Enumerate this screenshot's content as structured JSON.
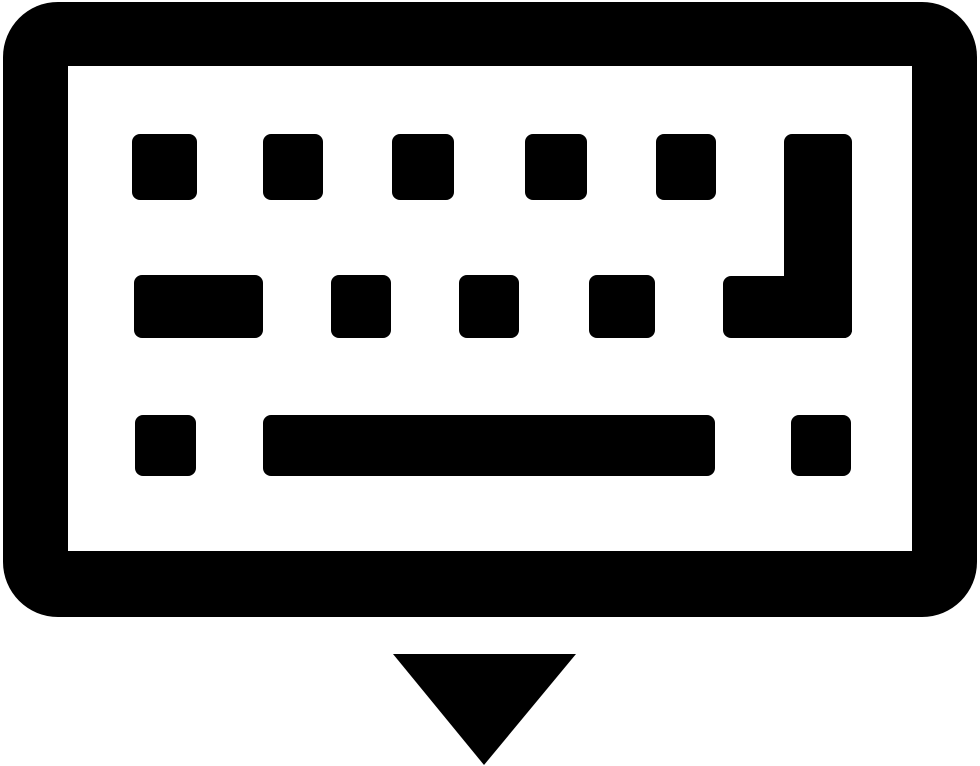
{
  "icon": {
    "name": "keyboard-hide-icon",
    "semantic": "Keyboard glyph with a downward-pointing triangle below it (hide on-screen keyboard)",
    "colors": {
      "glyph": "#000000",
      "background": "#ffffff"
    },
    "keyboard": {
      "frame": {
        "x": 3,
        "y": 2,
        "width": 974,
        "height": 615,
        "corner_radius": 55
      },
      "inner": {
        "x": 68,
        "y": 66,
        "width": 844,
        "height": 485
      },
      "key_corner_radius": 8,
      "rows": [
        {
          "name": "top-row",
          "y": 134,
          "height": 66,
          "keys": [
            {
              "name": "key",
              "x": 132,
              "w": 65
            },
            {
              "name": "key",
              "x": 263,
              "w": 60
            },
            {
              "name": "key",
              "x": 392,
              "w": 62
            },
            {
              "name": "key",
              "x": 525,
              "w": 62
            },
            {
              "name": "key",
              "x": 656,
              "w": 60
            }
          ]
        },
        {
          "name": "middle-row",
          "y": 275,
          "height": 63,
          "keys": [
            {
              "name": "wide-key",
              "x": 134,
              "w": 129
            },
            {
              "name": "key",
              "x": 331,
              "w": 60
            },
            {
              "name": "key",
              "x": 459,
              "w": 60
            },
            {
              "name": "key",
              "x": 589,
              "w": 66
            }
          ]
        },
        {
          "name": "bottom-row",
          "y": 415,
          "height": 61,
          "keys": [
            {
              "name": "key",
              "x": 135,
              "w": 61
            },
            {
              "name": "spacebar-key",
              "x": 263,
              "w": 452
            },
            {
              "name": "key",
              "x": 791,
              "w": 60
            }
          ]
        }
      ],
      "enter_key": {
        "vertical": {
          "x": 784,
          "y": 134,
          "w": 68,
          "h": 204
        },
        "foot": {
          "x": 723,
          "y": 276,
          "w": 129,
          "h": 62
        }
      }
    },
    "arrow": {
      "points": [
        [
          393,
          654
        ],
        [
          576,
          654
        ],
        [
          484,
          765
        ]
      ]
    }
  }
}
